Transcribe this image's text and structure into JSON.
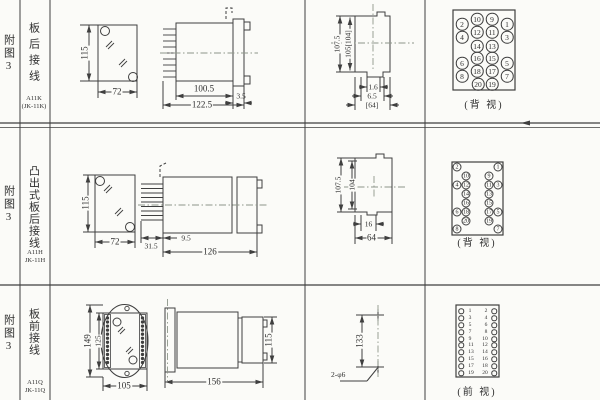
{
  "colors": {
    "bg": "#fbfbf8",
    "line": "#3f3f3f",
    "centerline": "#8e968a",
    "text": "#2e2e2e"
  },
  "rows": [
    {
      "fig": "附图3",
      "wiring": "板后接线",
      "model1": "A11K",
      "model2": "(JK-11K)",
      "dims": {
        "front_h": "115",
        "front_w": "72",
        "side_a": "100.5",
        "side_b": "3.5",
        "side_c": "122.5",
        "prof_v1": "107.5",
        "prof_v2": "105[104]",
        "prof_h1": "1.6",
        "prof_h2": "6.5",
        "prof_h3": "[64]"
      },
      "terminal": {
        "caption": "(背 视)",
        "style": "c1",
        "pins": [
          {
            "n": "10",
            "x": 477,
            "y": 19
          },
          {
            "n": "9",
            "x": 492,
            "y": 19
          },
          {
            "n": "2",
            "x": 462,
            "y": 24
          },
          {
            "n": "1",
            "x": 507,
            "y": 24
          },
          {
            "n": "12",
            "x": 477,
            "y": 32
          },
          {
            "n": "11",
            "x": 492,
            "y": 32
          },
          {
            "n": "4",
            "x": 462,
            "y": 37
          },
          {
            "n": "3",
            "x": 507,
            "y": 37
          },
          {
            "n": "14",
            "x": 477,
            "y": 46
          },
          {
            "n": "13",
            "x": 492,
            "y": 46
          },
          {
            "n": "16",
            "x": 477,
            "y": 58
          },
          {
            "n": "15",
            "x": 492,
            "y": 58
          },
          {
            "n": "6",
            "x": 462,
            "y": 63
          },
          {
            "n": "5",
            "x": 507,
            "y": 63
          },
          {
            "n": "18",
            "x": 477,
            "y": 71
          },
          {
            "n": "17",
            "x": 492,
            "y": 71
          },
          {
            "n": "8",
            "x": 462,
            "y": 76
          },
          {
            "n": "7",
            "x": 507,
            "y": 76
          },
          {
            "n": "20",
            "x": 478,
            "y": 84
          },
          {
            "n": "19",
            "x": 492,
            "y": 84
          }
        ]
      }
    },
    {
      "fig": "附图3",
      "wiring": "凸出式板后接线",
      "model1": "A11H",
      "model2": "JK-11H",
      "dims": {
        "front_h": "115",
        "front_w": "72",
        "side_a": "9.5",
        "side_b": "31.5",
        "side_c": "126",
        "prof_v1": "107.5",
        "prof_v2": "104",
        "prof_h1": "16",
        "prof_h2": "64"
      },
      "terminal": {
        "caption": "(背 视)",
        "style": "c2",
        "pins": [
          {
            "n": "2",
            "x": 457,
            "y": 167
          },
          {
            "n": "1",
            "x": 498,
            "y": 167
          },
          {
            "n": "10",
            "x": 466,
            "y": 176
          },
          {
            "n": "9",
            "x": 489,
            "y": 176
          },
          {
            "n": "4",
            "x": 457,
            "y": 185
          },
          {
            "n": "12",
            "x": 466,
            "y": 185
          },
          {
            "n": "11",
            "x": 489,
            "y": 185
          },
          {
            "n": "3",
            "x": 498,
            "y": 185
          },
          {
            "n": "14",
            "x": 466,
            "y": 194
          },
          {
            "n": "13",
            "x": 489,
            "y": 194
          },
          {
            "n": "16",
            "x": 466,
            "y": 203
          },
          {
            "n": "15",
            "x": 489,
            "y": 203
          },
          {
            "n": "6",
            "x": 457,
            "y": 212
          },
          {
            "n": "18",
            "x": 466,
            "y": 212
          },
          {
            "n": "17",
            "x": 489,
            "y": 212
          },
          {
            "n": "5",
            "x": 498,
            "y": 212
          },
          {
            "n": "20",
            "x": 466,
            "y": 221
          },
          {
            "n": "19",
            "x": 489,
            "y": 221
          },
          {
            "n": "8",
            "x": 457,
            "y": 229
          },
          {
            "n": "7",
            "x": 498,
            "y": 229
          }
        ]
      }
    },
    {
      "fig": "附图3",
      "wiring": "板前接线",
      "model1": "A11Q",
      "model2": "JK-11Q",
      "dims": {
        "front_h1": "149",
        "front_h2": "125",
        "front_w": "105",
        "side_h": "115",
        "side_w": "156",
        "drill_v": "133",
        "drill_note": "2-φ6"
      },
      "terminal": {
        "caption": "(前 视)",
        "style": "c3",
        "pins": [
          {
            "n": "1",
            "cx": 461,
            "tx": 470,
            "y": 311
          },
          {
            "n": "2",
            "cx": 494,
            "tx": 486,
            "y": 311
          },
          {
            "n": "3",
            "cx": 461,
            "tx": 470,
            "y": 318
          },
          {
            "n": "4",
            "cx": 494,
            "tx": 486,
            "y": 318
          },
          {
            "n": "5",
            "cx": 461,
            "tx": 470,
            "y": 325
          },
          {
            "n": "6",
            "cx": 494,
            "tx": 486,
            "y": 325
          },
          {
            "n": "7",
            "cx": 461,
            "tx": 470,
            "y": 332
          },
          {
            "n": "8",
            "cx": 494,
            "tx": 486,
            "y": 332
          },
          {
            "n": "9",
            "cx": 461,
            "tx": 470,
            "y": 339
          },
          {
            "n": "10",
            "cx": 494,
            "tx": 485,
            "y": 339
          },
          {
            "n": "11",
            "cx": 461,
            "tx": 471,
            "y": 345
          },
          {
            "n": "12",
            "cx": 494,
            "tx": 485,
            "y": 345
          },
          {
            "n": "13",
            "cx": 461,
            "tx": 471,
            "y": 352
          },
          {
            "n": "14",
            "cx": 494,
            "tx": 485,
            "y": 352
          },
          {
            "n": "15",
            "cx": 461,
            "tx": 471,
            "y": 359
          },
          {
            "n": "16",
            "cx": 494,
            "tx": 485,
            "y": 359
          },
          {
            "n": "17",
            "cx": 461,
            "tx": 471,
            "y": 366
          },
          {
            "n": "18",
            "cx": 494,
            "tx": 485,
            "y": 366
          },
          {
            "n": "19",
            "cx": 461,
            "tx": 471,
            "y": 373
          },
          {
            "n": "20",
            "cx": 494,
            "tx": 485,
            "y": 373
          }
        ]
      }
    }
  ]
}
